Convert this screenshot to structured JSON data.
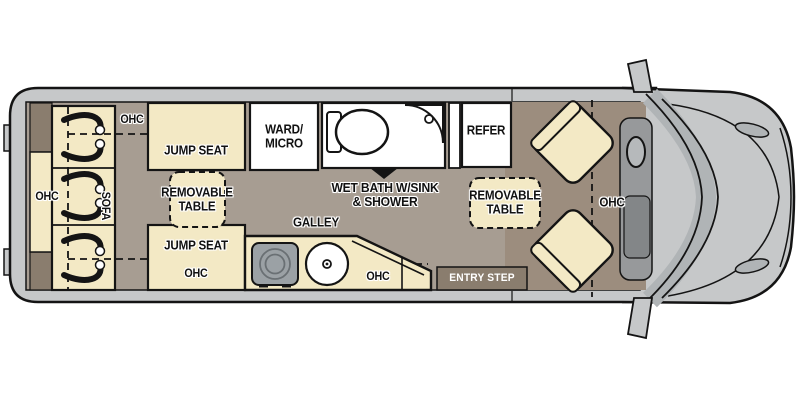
{
  "colors": {
    "background": "#ffffff",
    "van_wall": "#c6c8c9",
    "coach_floor": "#a79d92",
    "cab_floor": "#9c8d7e",
    "furniture_cream": "#f3e9c5",
    "fixture_white": "#ffffff",
    "dark_trim": "#8a7d6e",
    "stove_gray": "#9ba1a5",
    "windshield_gray": "#b0b4b6",
    "outline": "#141414",
    "label_text": "#111111",
    "entry_step_text": "#ffffff"
  },
  "labels": {
    "ohc_top": "OHC",
    "jump_seat_front": "JUMP SEAT",
    "removable_table_left": {
      "line1": "REMOVABLE",
      "line2": "TABLE"
    },
    "jump_seat_rear": "JUMP SEAT",
    "ohc_jump_rear": "OHC",
    "ohc_sofa": "OHC",
    "sofa": "SOFA",
    "ward_micro": {
      "line1": "WARD/",
      "line2": "MICRO"
    },
    "wet_bath": {
      "line1": "WET BATH W/SINK",
      "line2": "& SHOWER"
    },
    "refer": "REFER",
    "galley": "GALLEY",
    "ohc_galley": "OHC",
    "removable_table_right": {
      "line1": "REMOVABLE",
      "line2": "TABLE"
    },
    "ohc_cab": "OHC",
    "entry_step": "ENTRY STEP"
  },
  "icons": [
    "seatbelt-icon",
    "toilet-icon",
    "corner-shower-icon",
    "sink-icon",
    "cooktop-icon",
    "swivel-seat-icon",
    "van-front-icon"
  ]
}
